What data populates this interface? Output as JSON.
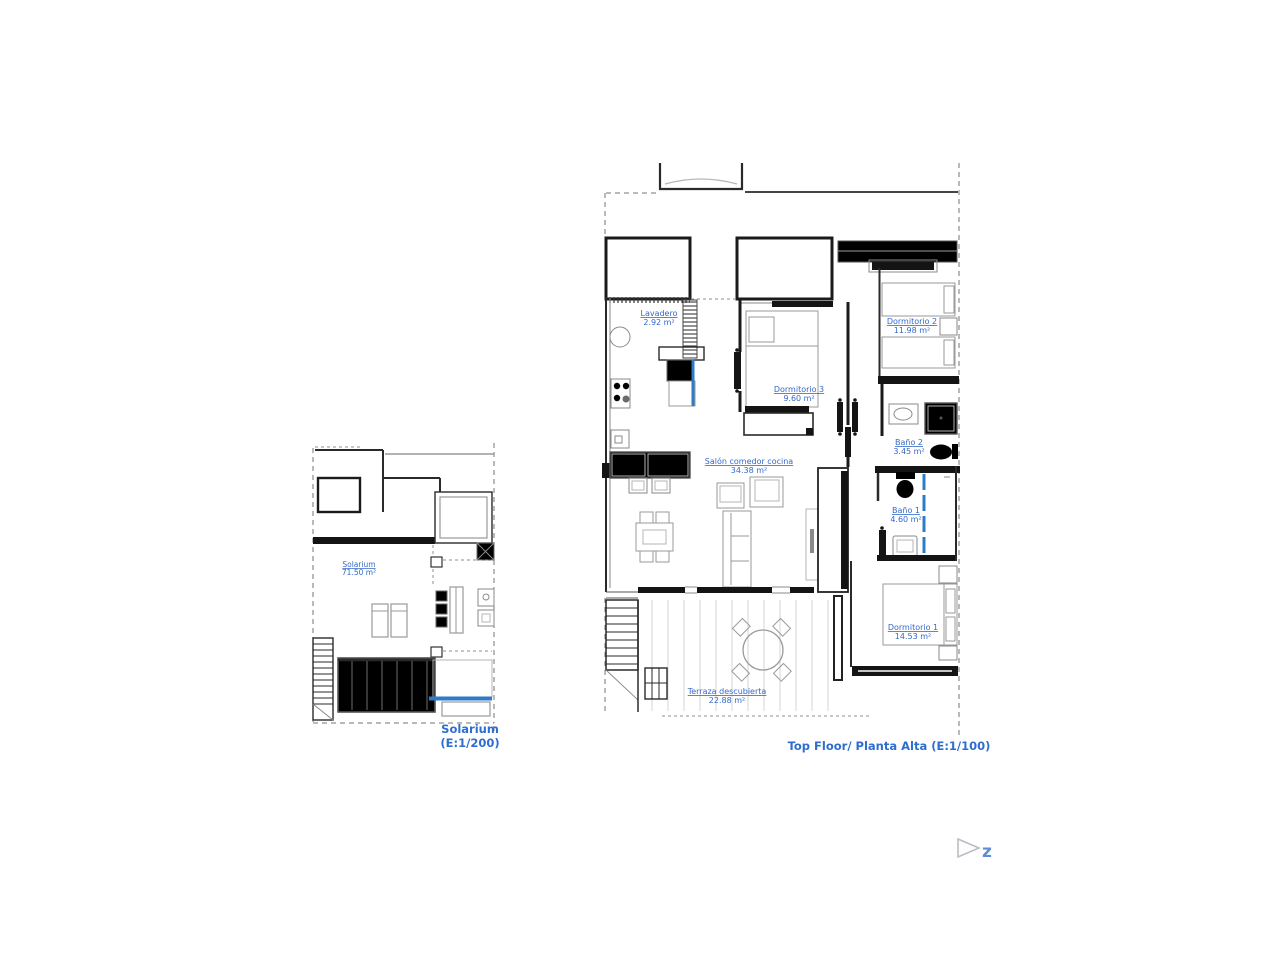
{
  "colors": {
    "accent_blue": "#2E7CC8",
    "label_blue": "#3468C9",
    "caption_blue": "#2E6ED0",
    "wall_dark": "#141414",
    "furniture_gray": "#9A9A9A"
  },
  "plans": [
    {
      "id": "solarium-plan",
      "caption_line1": "Solarium",
      "caption_line2": "(E:1/200)",
      "rooms": [
        {
          "name": "Solarium",
          "area": "71.50 m²"
        }
      ]
    },
    {
      "id": "top-floor-plan",
      "caption": "Top Floor/ Planta Alta (E:1/100)",
      "rooms": [
        {
          "name": "Lavadero",
          "area": "2.92 m²"
        },
        {
          "name": "Dormitorio 3",
          "area": "9.60 m²"
        },
        {
          "name": "Dormitorio 2",
          "area": "11.98 m²"
        },
        {
          "name": "Baño 2",
          "area": "3.45 m²"
        },
        {
          "name": "Salón comedor cocina",
          "area": "34.38 m²"
        },
        {
          "name": "Baño 1",
          "area": "4.60 m²"
        },
        {
          "name": "Dormitorio 1",
          "area": "14.53 m²"
        },
        {
          "name": "Terraza descubierta",
          "area": "22.88 m²"
        }
      ]
    }
  ],
  "logo": {
    "mark": "z"
  }
}
